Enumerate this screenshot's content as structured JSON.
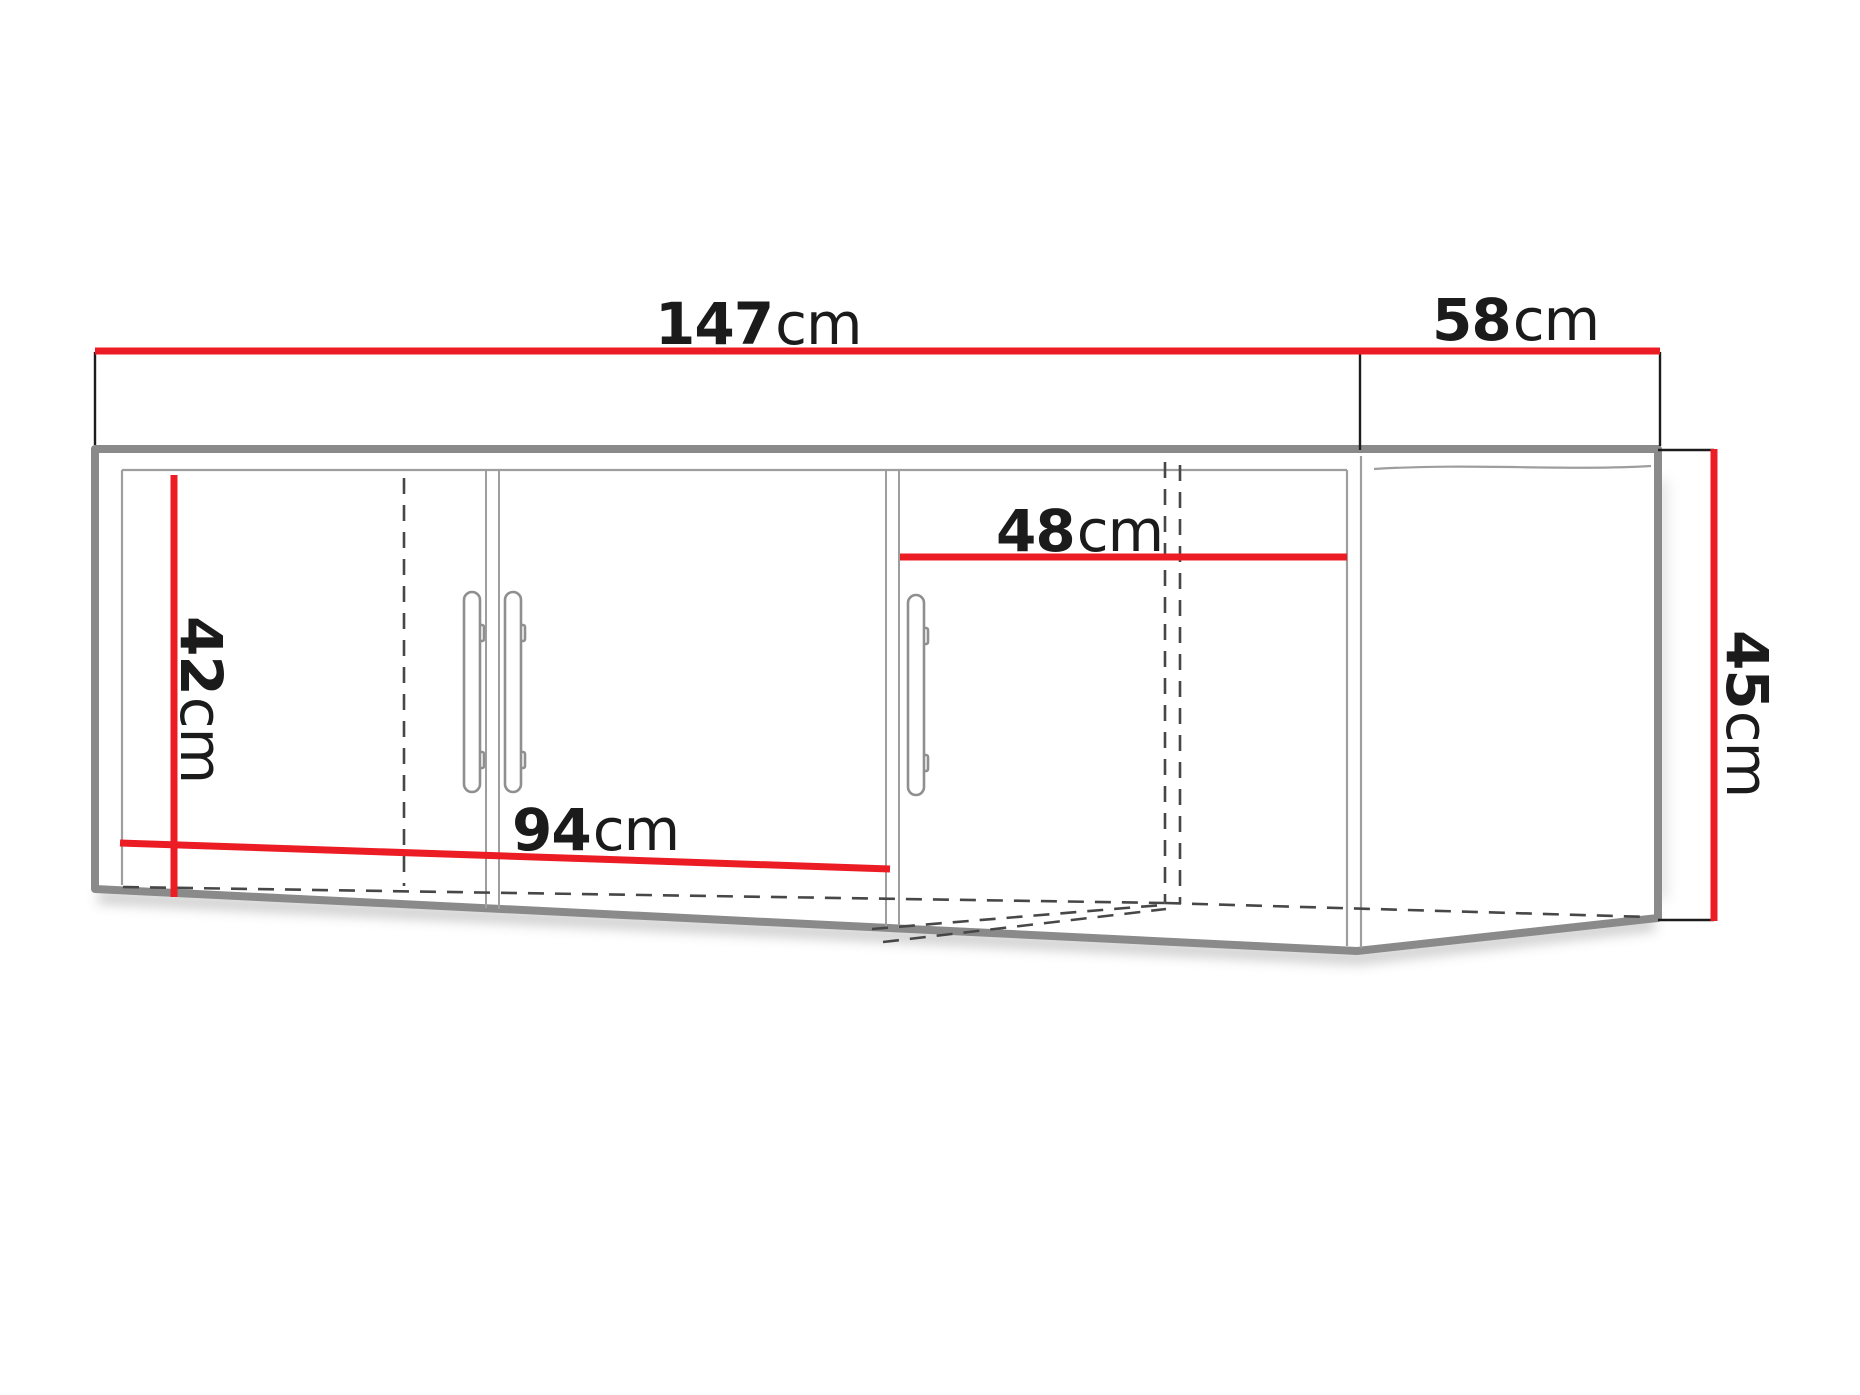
{
  "diagram": {
    "kind": "corner wall cabinet dimension drawing",
    "units": "cm",
    "dims": {
      "width_main": {
        "value": "147",
        "unit": "cm"
      },
      "width_side": {
        "value": "58",
        "unit": "cm"
      },
      "height": {
        "value": "45",
        "unit": "cm"
      },
      "interior_height": {
        "value": "42",
        "unit": "cm"
      },
      "interior_width_main": {
        "value": "94",
        "unit": "cm"
      },
      "interior_width_side": {
        "value": "48",
        "unit": "cm"
      }
    },
    "colors": {
      "dimension_red": "#ec1c24",
      "outline_gray": "#8a8a8a",
      "thin_line_gray": "#9e9e9e",
      "dashed_gray": "#474747",
      "text": "#1b1b1b"
    }
  }
}
